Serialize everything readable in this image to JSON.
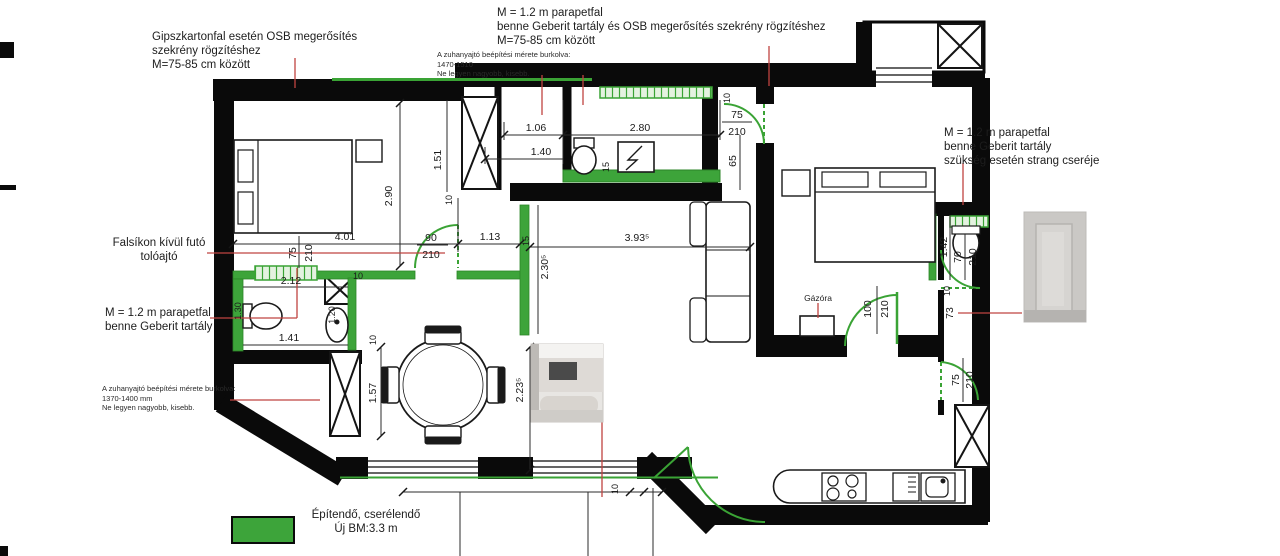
{
  "annotations": {
    "gips": {
      "lines": [
        "Gipszkartonfal esetén OSB megerősítés",
        "szekrény rögzítéshez",
        "M=75-85 cm között"
      ]
    },
    "parapet_top": {
      "lines": [
        "M = 1.2 m parapetfal",
        "benne Geberit tartály és OSB megerősítés szekrény rögzítéshez",
        "M=75-85 cm között"
      ]
    },
    "shower_top": {
      "lines": [
        "A zuhanyajtó beépítési mérete burkolva:",
        "1470-1510",
        "Ne legyen nagyobb, kisebb."
      ]
    },
    "parapet_right": {
      "lines": [
        "M = 1.2 m parapetfal",
        "benne Geberit tartály",
        "szükség esetén strang cseréje"
      ]
    },
    "sliding": {
      "lines": [
        "Falsíkon kívül futó",
        "tolóajtó"
      ]
    },
    "parapet_left": {
      "lines": [
        "M = 1.2 m parapetfal",
        "benne Geberit tartály"
      ]
    },
    "shower_left": {
      "lines": [
        "A zuhanyajtó beépítési mérete burkolva:",
        "1370-1400 mm",
        "Ne legyen nagyobb, kisebb."
      ]
    },
    "gas_meter": "Gázóra"
  },
  "legend": {
    "line1": "Építendő, cserélendő",
    "line2": "Új BM:3.3 m"
  },
  "dims": {
    "v151": "1.51",
    "v106": "1.06",
    "v140": "1.40",
    "v280": "2.80",
    "v290": "2.90",
    "v401": "4.01",
    "v75a": "75",
    "v210a": "210",
    "v90": "90",
    "v210b": "210",
    "v113": "1.13",
    "v15a": "15",
    "v393": "3.93⁵",
    "v230": "2.30⁵",
    "v212": "2.12",
    "v141": "1.41",
    "v130": "1.30",
    "v120": "1.20",
    "v10a": "10",
    "v10b": "10",
    "v10c": "10",
    "v157": "1.57",
    "v223": "2.23⁵",
    "v10d": "10",
    "v75b": "75",
    "v210c": "210",
    "v65": "65",
    "v15b": "15",
    "v142": "1.42",
    "v70": "70",
    "v210d": "210",
    "v10e": "10",
    "v73": "73",
    "v100": "100",
    "v210e": "210",
    "v75c": "75",
    "v210f": "210",
    "v10f": "10"
  },
  "colors": {
    "wall": "#0a0a0a",
    "green": "#3aa335",
    "green_fill": "#3DA43A",
    "hatch_bg": "#e4f2e0",
    "red": "#bf4340"
  }
}
